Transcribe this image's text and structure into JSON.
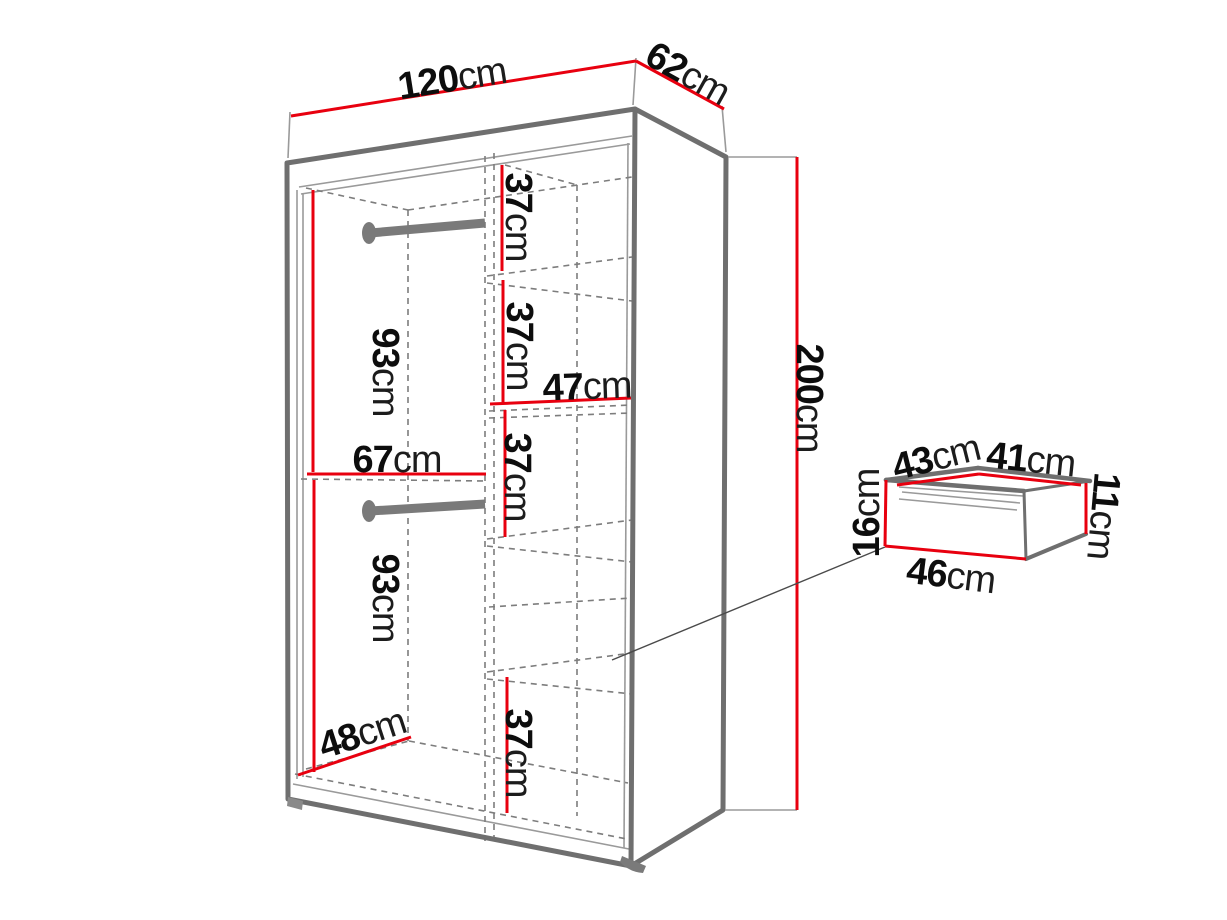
{
  "diagram": {
    "kind": "wardrobe-dimension-diagram",
    "unit": "cm"
  },
  "colors": {
    "dimension_red": "#e8000f",
    "outline_gray": "#6f6f6f",
    "line_gray": "#9a9a9a",
    "dash_gray": "#7d7d7d",
    "rod_gray": "#7a7a7a",
    "label_black": "#111111",
    "background": "#ffffff"
  },
  "dimensions": {
    "width_top": {
      "value": "120",
      "unit": "cm"
    },
    "depth_top": {
      "value": "62",
      "unit": "cm"
    },
    "height_right": {
      "value": "200",
      "unit": "cm"
    },
    "hanging_upper": {
      "value": "93",
      "unit": "cm"
    },
    "left_section_width": {
      "value": "67",
      "unit": "cm"
    },
    "hanging_lower": {
      "value": "93",
      "unit": "cm"
    },
    "left_section_depth": {
      "value": "48",
      "unit": "cm"
    },
    "shelf_gap_1": {
      "value": "37",
      "unit": "cm"
    },
    "shelf_gap_2": {
      "value": "37",
      "unit": "cm"
    },
    "right_section_width": {
      "value": "47",
      "unit": "cm"
    },
    "shelf_gap_3": {
      "value": "37",
      "unit": "cm"
    },
    "shelf_gap_4": {
      "value": "37",
      "unit": "cm"
    },
    "drawer_back_width": {
      "value": "43",
      "unit": "cm"
    },
    "drawer_top_width": {
      "value": "41",
      "unit": "cm"
    },
    "drawer_front_height": {
      "value": "16",
      "unit": "cm"
    },
    "drawer_side_height": {
      "value": "11",
      "unit": "cm"
    },
    "drawer_front_width": {
      "value": "46",
      "unit": "cm"
    }
  }
}
